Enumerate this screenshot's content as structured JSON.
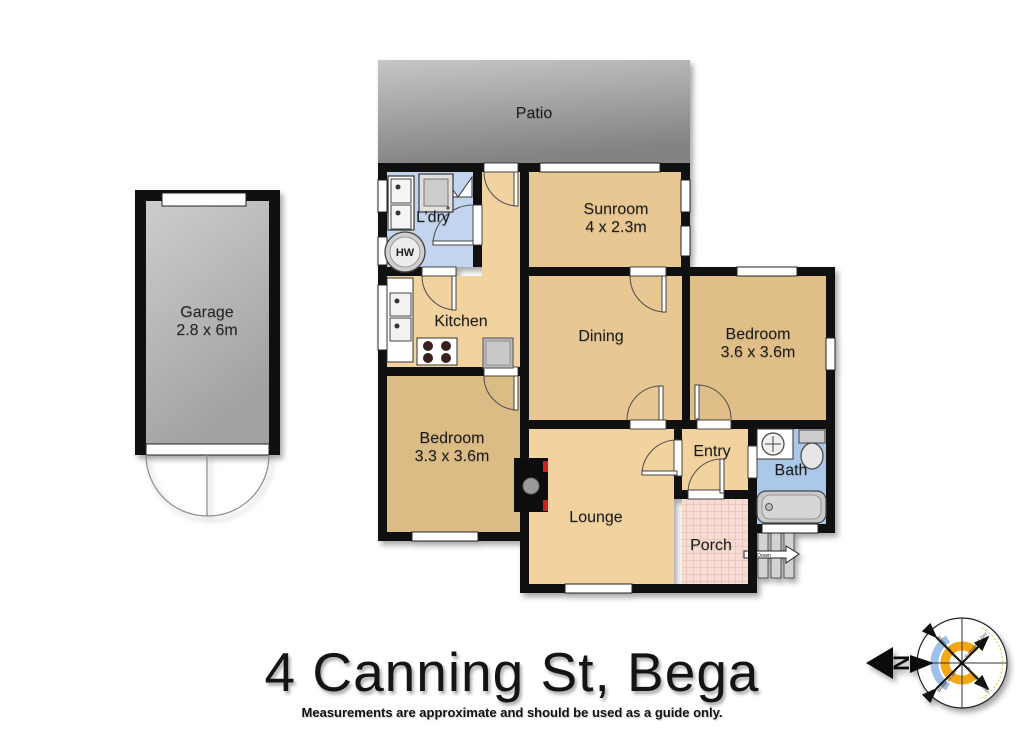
{
  "title": "4 Canning St, Bega",
  "disclaimer": "Measurements are approximate and should be used as a guide only.",
  "rooms": {
    "patio": {
      "label": "Patio"
    },
    "garage": {
      "label": "Garage",
      "dims": "2.8 x 6m"
    },
    "laundry": {
      "label": "L’dry"
    },
    "sunroom": {
      "label": "Sunroom",
      "dims": "4 x 2.3m"
    },
    "kitchen": {
      "label": "Kitchen"
    },
    "dining": {
      "label": "Dining"
    },
    "bedroom_right": {
      "label": "Bedroom",
      "dims": "3.6 x 3.6m"
    },
    "bedroom_left": {
      "label": "Bedroom",
      "dims": "3.3 x 3.6m"
    },
    "entry": {
      "label": "Entry"
    },
    "bath": {
      "label": "Bath"
    },
    "lounge": {
      "label": "Lounge"
    },
    "porch": {
      "label": "Porch"
    }
  },
  "fixtures": {
    "hot_water": "HW",
    "stairs_direction": "Down"
  },
  "compass": {
    "north": "N",
    "labels": [
      "Winter 21 Jun",
      "Summer 21 Dec",
      "Winter 21 Jun",
      "Summer 21 Dec"
    ]
  },
  "colors": {
    "wall": "#101010",
    "floor_tan_light": "#f2d3a0",
    "floor_tan_mid": "#e8c792",
    "floor_tan_dark": "#dcbc85",
    "floor_laundry_blue": "#c3d5ee",
    "floor_bath_blue": "#abc8e9",
    "porch_pink": "#f6dcd2",
    "porch_grid": "#e2b5a5",
    "patio_gray_top": "#c6c6c6",
    "patio_gray_bottom": "#838383",
    "garage_gray_top": "#cdcdcd",
    "garage_gray_bottom": "#a2a2a2",
    "fireplace_red": "#cc2222",
    "compass_orange": "#f3a712",
    "compass_blue": "#9fc0e6"
  }
}
